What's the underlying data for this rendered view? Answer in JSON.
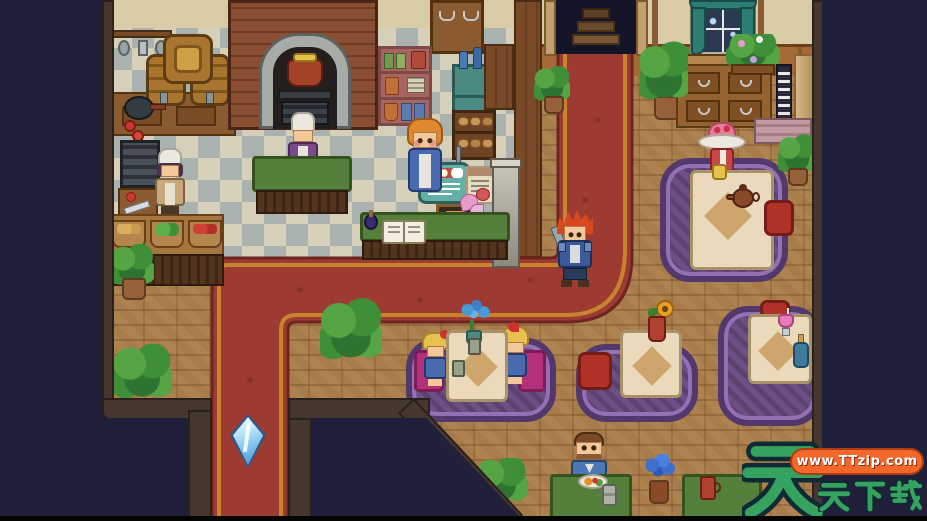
{
  "watermark": {
    "big_char": "天",
    "brand_chars": [
      "天",
      "下",
      "载"
    ],
    "brand_text": "天天下载",
    "url_text": "www.TTzip.com",
    "text_color": "#2f9e5d",
    "pill_color": "#f2672a"
  },
  "scene": {
    "location": "pixel-art tavern restaurant interior",
    "characters": [
      {
        "id": "chef-left",
        "label": "Chef in tan apron"
      },
      {
        "id": "chef-center",
        "label": "Cook at prep table"
      },
      {
        "id": "shop-girl",
        "label": "Counter attendant"
      },
      {
        "id": "player",
        "label": "Red-haired adventurer with sword"
      },
      {
        "id": "hat-lady",
        "label": "Lady in flower hat"
      },
      {
        "id": "twin-girl-left",
        "label": "Blonde girl with red bow"
      },
      {
        "id": "twin-girl-right",
        "label": "Blonde girl with red bow"
      },
      {
        "id": "man-eating",
        "label": "Bearded diner eating"
      }
    ],
    "objects": [
      {
        "id": "stairway-door",
        "label": "Stairway exit"
      },
      {
        "id": "brick-oven",
        "label": "Brick oven with stew pot"
      },
      {
        "id": "wine-barrels",
        "label": "Wine barrels"
      },
      {
        "id": "menu-sign",
        "label": "Hanging menu sign"
      },
      {
        "id": "shop-counter",
        "label": "Service counter with ledger"
      },
      {
        "id": "save-crystal",
        "label": "Blue save crystal"
      },
      {
        "id": "window",
        "label": "Curtained window"
      },
      {
        "id": "dining-table",
        "label": "Dining table"
      },
      {
        "id": "carpet-path",
        "label": "Red carpet path"
      }
    ],
    "palette": {
      "background": "#20203a",
      "wood_floor": "#a87c4a",
      "tile_light": "#d6cfba",
      "tile_dark": "#a9b2af",
      "carpet": "#9d3b33",
      "carpet_border": "#c8832f",
      "rug_purple": "#6d4f86",
      "wall_tan": "#d9cba6",
      "brick": "#8a4f32",
      "cushion_red": "#b03228",
      "bench_magenta": "#b5307a",
      "crystal_blue": "#8ed0f4"
    }
  }
}
